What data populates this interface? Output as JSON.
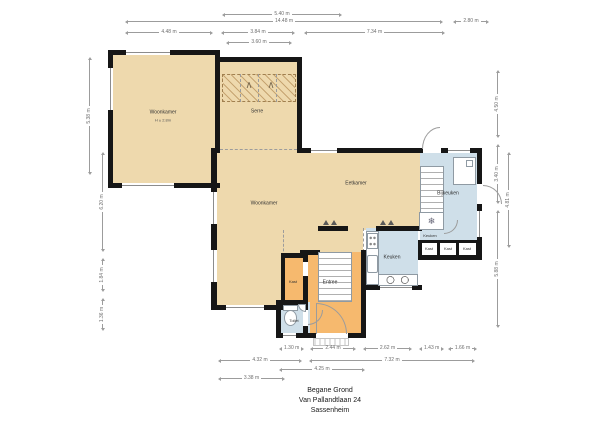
{
  "footer": {
    "line1": "Begane Grond",
    "line2": "Van Pallandtlaan 24",
    "line3": "Sassenheim"
  },
  "rooms": {
    "woonkamer_tl": {
      "label": "Woonkamer",
      "sub": "H ± 2.8m"
    },
    "serre": {
      "label": "Serre"
    },
    "woonkamer": {
      "label": "Woonkamer"
    },
    "eetkamer": {
      "label": "Eetkamer"
    },
    "bijkeuken": {
      "label": "Bijkeuken"
    },
    "keuken": {
      "label": "Keuken"
    },
    "keuken2": {
      "label": "Keuken"
    },
    "entree": {
      "label": "Entree"
    },
    "kast": {
      "label": "Kast"
    },
    "toilet": {
      "label": "Toilet"
    },
    "kast_a": {
      "label": "Kast"
    },
    "kast_b": {
      "label": "Kast"
    },
    "kast_c": {
      "label": "Kast"
    }
  },
  "dims": {
    "top": [
      {
        "label": "5.40 m"
      },
      {
        "label": "14.48 m"
      },
      {
        "label": "2.80 m"
      },
      {
        "label": "4.48 m"
      },
      {
        "label": "3.84 m"
      },
      {
        "label": "7.34 m"
      },
      {
        "label": "3.60 m"
      }
    ],
    "bottom": [
      {
        "label": "1.30 m"
      },
      {
        "label": "2.44 m"
      },
      {
        "label": "2.62 m"
      },
      {
        "label": "1.43 m"
      },
      {
        "label": "1.66 m"
      },
      {
        "label": "4.32 m"
      },
      {
        "label": "7.32 m"
      },
      {
        "label": "4.25 m"
      },
      {
        "label": "3.38 m"
      }
    ],
    "left": [
      {
        "label": "5.38 m"
      },
      {
        "label": "6.20 m"
      },
      {
        "label": "1.84 m"
      },
      {
        "label": "1.36 m"
      }
    ],
    "right": [
      {
        "label": "4.50 m"
      },
      {
        "label": "3.40 m"
      },
      {
        "label": "5.88 m"
      },
      {
        "label": "4.81 m"
      }
    ]
  },
  "icons": {
    "freezer": "❄",
    "door_swing": "∧"
  },
  "colors": {
    "room_tan": "#eed9ad",
    "room_blue": "#cfdfe9",
    "room_orange": "#f6b96e",
    "wall": "#161616"
  }
}
